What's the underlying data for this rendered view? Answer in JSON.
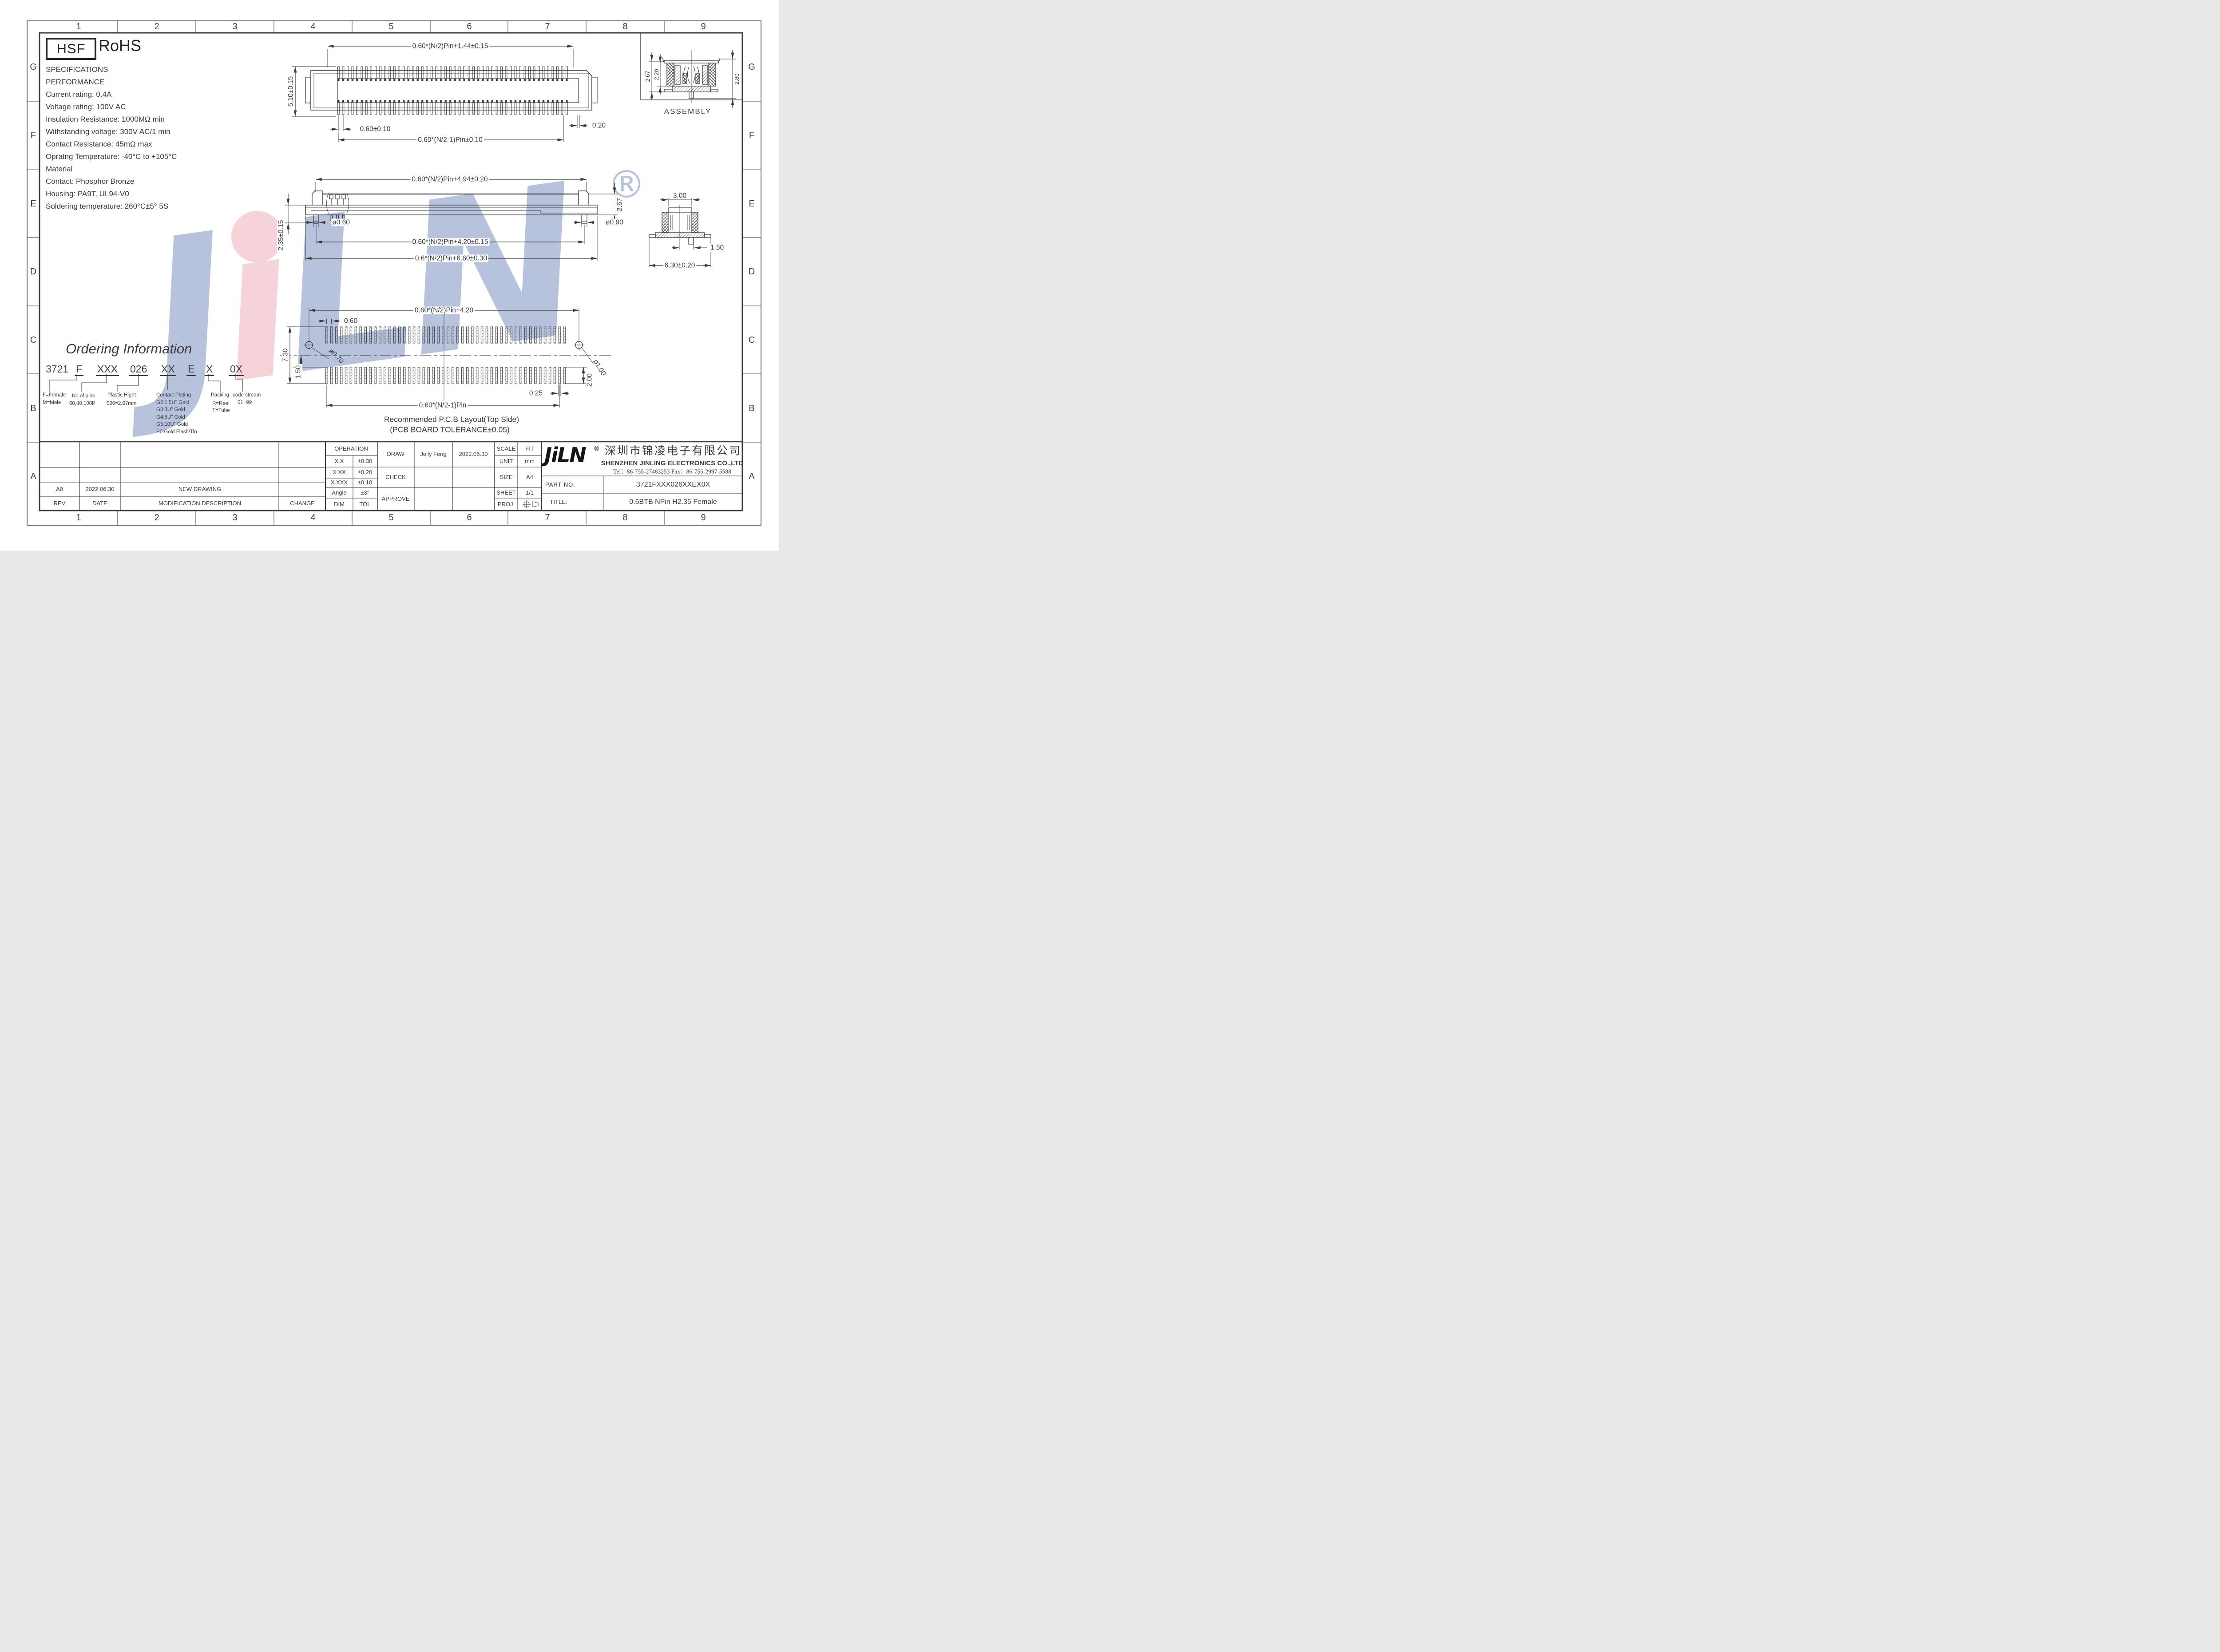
{
  "page": {
    "line_color": "#3b3b3b",
    "watermark_blue": "#b7c3dc",
    "watermark_pink": "#f6d3d9"
  },
  "frame": {
    "columns": [
      "1",
      "2",
      "3",
      "4",
      "5",
      "6",
      "7",
      "8",
      "9"
    ],
    "rows": [
      "G",
      "F",
      "E",
      "D",
      "C",
      "B",
      "A"
    ]
  },
  "badges": {
    "hsf": "HSF",
    "rohs": "RoHS"
  },
  "specs": {
    "lines": [
      "SPECIFICATIONS",
      "PERFORMANCE",
      "Current rating: 0.4A",
      "Voltage rating: 100V AC",
      "Insulation Resistance: 1000MΩ min",
      "Withstanding voltage: 300V AC/1 min",
      "Contact Resistance: 45mΩ max",
      "Opratng Temperature: -40°C to +105°C",
      "Material",
      "Contact: Phosphor Bronze",
      "Housing: PA9T, UL94-V0",
      "Soldering temperature: 260°C±5° 5S"
    ]
  },
  "watermark": {
    "j": "J",
    "i": "ı",
    "l": "L",
    "n": "N",
    "registered": "®"
  },
  "top_view": {
    "pin_count": 50,
    "dim_width_top": "0.60*(N/2)Pin+1.44±0.15",
    "dim_height_left": "5.10±0.15",
    "dim_pitch": "0.60±0.10",
    "dim_pad": "0.20",
    "dim_span_bottom": "0.60*(N/2-1)Pin±0.10"
  },
  "side_view": {
    "dim_width_top": "0.60*(N/2)Pin+4.94±0.20",
    "dim_height_right": "2.67",
    "dim_left": "2.35±0.15",
    "dim_pin_left": "ø0.60",
    "dim_pin_right": "ø0.90",
    "dim_span_mid": "0.60*(N/2)Pin+4.20±0.15",
    "dim_span_bottom": "0.6*(N/2)Pin+6.60±0.30"
  },
  "cross_section": {
    "dim_top": "3.00",
    "dim_right": "1.50",
    "dim_bottom": "6.30±0.20"
  },
  "assembly": {
    "label": "ASSEMBLY",
    "dim_left_outer": "2.67",
    "dim_left_inner": "2.20",
    "dim_right": "2.80"
  },
  "pcb_layout": {
    "pad_count": 50,
    "dim_width_top": "0.60*(N/2)Pin+4.20",
    "dim_pitch": "0.60",
    "dim_height_left": "7.30",
    "dim_offset_left": "1.50",
    "dim_hole_left": "ø0.70",
    "dim_hole_right": "ø1.00",
    "dim_pad_gap": "0.25",
    "dim_pad_len": "2.00",
    "dim_span_bottom": "0.60*(N/2-1)Pin",
    "caption1": "Recommended P.C.B Layout(Top Side)",
    "caption2": "(PCB BOARD TOLERANCE±0.05)"
  },
  "ordering": {
    "title": "Ordering Information",
    "code": [
      "3721",
      "F",
      "XXX",
      "026",
      "XX",
      "E",
      "X",
      "0X"
    ],
    "gender": [
      "F=Female",
      "M=Male"
    ],
    "pins": [
      "No.of pins",
      "60,80,100P"
    ],
    "plastic": [
      "Plastic Hight",
      "026=2.67mm"
    ],
    "plating": [
      "Contact Plating",
      "G2:1.5U\" Gold",
      "G3:3U\" Gold",
      "G4:5U\" Gold",
      "G5:10U\" Gold",
      "S0:Gold Flash/Tin"
    ],
    "packing": [
      "Packing",
      "R=Reel",
      "T=Tube"
    ],
    "stream": [
      "code stream",
      "01~99"
    ]
  },
  "title_block": {
    "operation": "OPERATION",
    "tol_rows": [
      [
        "X.X",
        "±0.30"
      ],
      [
        "X.XX",
        "±0.20"
      ],
      [
        "X.XXX",
        "±0.10"
      ],
      [
        "Angle",
        "±3°"
      ],
      [
        "DIM",
        "TOL"
      ]
    ],
    "draw": "DRAW",
    "check": "CHECK",
    "approve": "APPROVE",
    "drawn_by": "Jelly Feng",
    "draw_date": "2022.06.30",
    "scale_label": "SCALE",
    "scale": "FIT",
    "unit_label": "UNIT",
    "unit": "mm",
    "size_label": "SIZE",
    "size": "A4",
    "sheet_label": "SHEET",
    "sheet": "1/1",
    "proj_label": "PROJ.",
    "logo": "JiLN",
    "logo_reg": "®",
    "company_cn": "深圳市锦凌电子有限公司",
    "company_en": "SHENZHEN JINLING ELECTRONICS CO.,LTD",
    "tel": "Tel：86-755-27483253  Fax：86-755-2997-5588",
    "part_no_label": "PART NO.",
    "part_no": "3721FXXX026XXEX0X",
    "title_label": "TITLE:",
    "title": "0.6BTB NPin H2.35 Female",
    "rev_row": [
      "A0",
      "2022.06.30",
      "NEW DRAWING"
    ],
    "rev_header": [
      "REV",
      "DATE",
      "MODIFICATION DESCRIPTION",
      "CHANGE"
    ]
  }
}
